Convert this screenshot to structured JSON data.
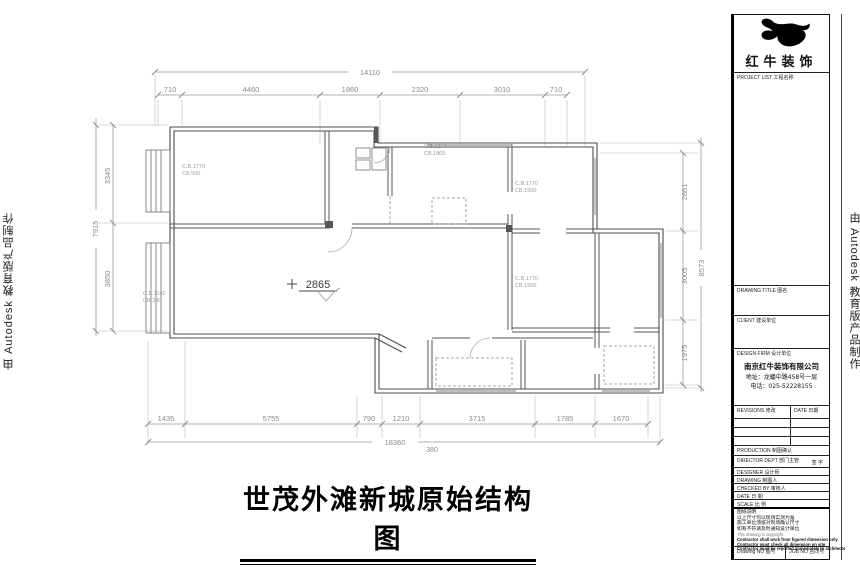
{
  "sheet": {
    "main_title": "世茂外滩新城原始结构图",
    "watermark_left": "由 Autodesk 教育版产品制作",
    "watermark_right": "由 Autodesk 教育版产品制作"
  },
  "plan": {
    "dims": {
      "top_total": "14110",
      "top": [
        "710",
        "4460",
        "1860",
        "2320",
        "3010",
        "710"
      ],
      "bottom": [
        "1435",
        "5755",
        "790",
        "1210",
        "3715",
        "1785",
        "1670"
      ],
      "bottom_total": "18360",
      "bottom_offset": "380",
      "left": [
        "3345",
        "3850"
      ],
      "left_total": "7915",
      "right": [
        "2661",
        "3005",
        "1975"
      ],
      "right_total": "8573"
    },
    "level_marker": "2865",
    "room_labels": [
      {
        "line1": "C.B.1770",
        "line2": "CB.500"
      },
      {
        "line1": "C.B.1240",
        "line2": "CB.1805"
      },
      {
        "line1": "C.B.1770",
        "line2": "CB.1500"
      },
      {
        "line1": "C.B.1770",
        "line2": "CB.1500"
      },
      {
        "line1": "C.B.1140",
        "line2": "CB.340"
      }
    ]
  },
  "titleblock": {
    "brand": "红牛装饰",
    "project_label": "PROJECT LIST 工程名称",
    "drawing_title_label": "DRAWING TITLE 图名",
    "client_label": "CLIENT 建设单位",
    "design_firm_label": "DESIGN FIRM 设计单位",
    "company_name": "南京红牛装饰有限公司",
    "company_address": "地址：龙蟠中路458号一层",
    "company_phone": "电话：025-52228155",
    "revisions_label": "REVISIONS 修改",
    "revisions_date_label": "DATE 日期",
    "production_label": "PRODUCTION 制图确认",
    "director_label": "DIRECTOR DEPT 部门主管",
    "sign_label": "签 字",
    "designer_label": "DESIGNER 设计师",
    "drafter_label": "DRAWING 制图人",
    "checked_label": "CHECKED BY 审核人",
    "date_label": "DATE 日 期",
    "scale_label": "SCALE 比 例",
    "notes": [
      "图纸说明",
      "以上尺寸均以现场实测为准",
      "施工单位须核对现场确认尺寸",
      "如有不符请及时通知设计单位",
      "This drawing is copyright",
      "Contractor shall work from figured dimension only",
      "Contractor must check all dimension on site",
      "Contractor must be reported immediately to architects"
    ],
    "drawing_no_label": "Drawing NO 图号",
    "job_no_label": "JOB NO 合同号"
  }
}
